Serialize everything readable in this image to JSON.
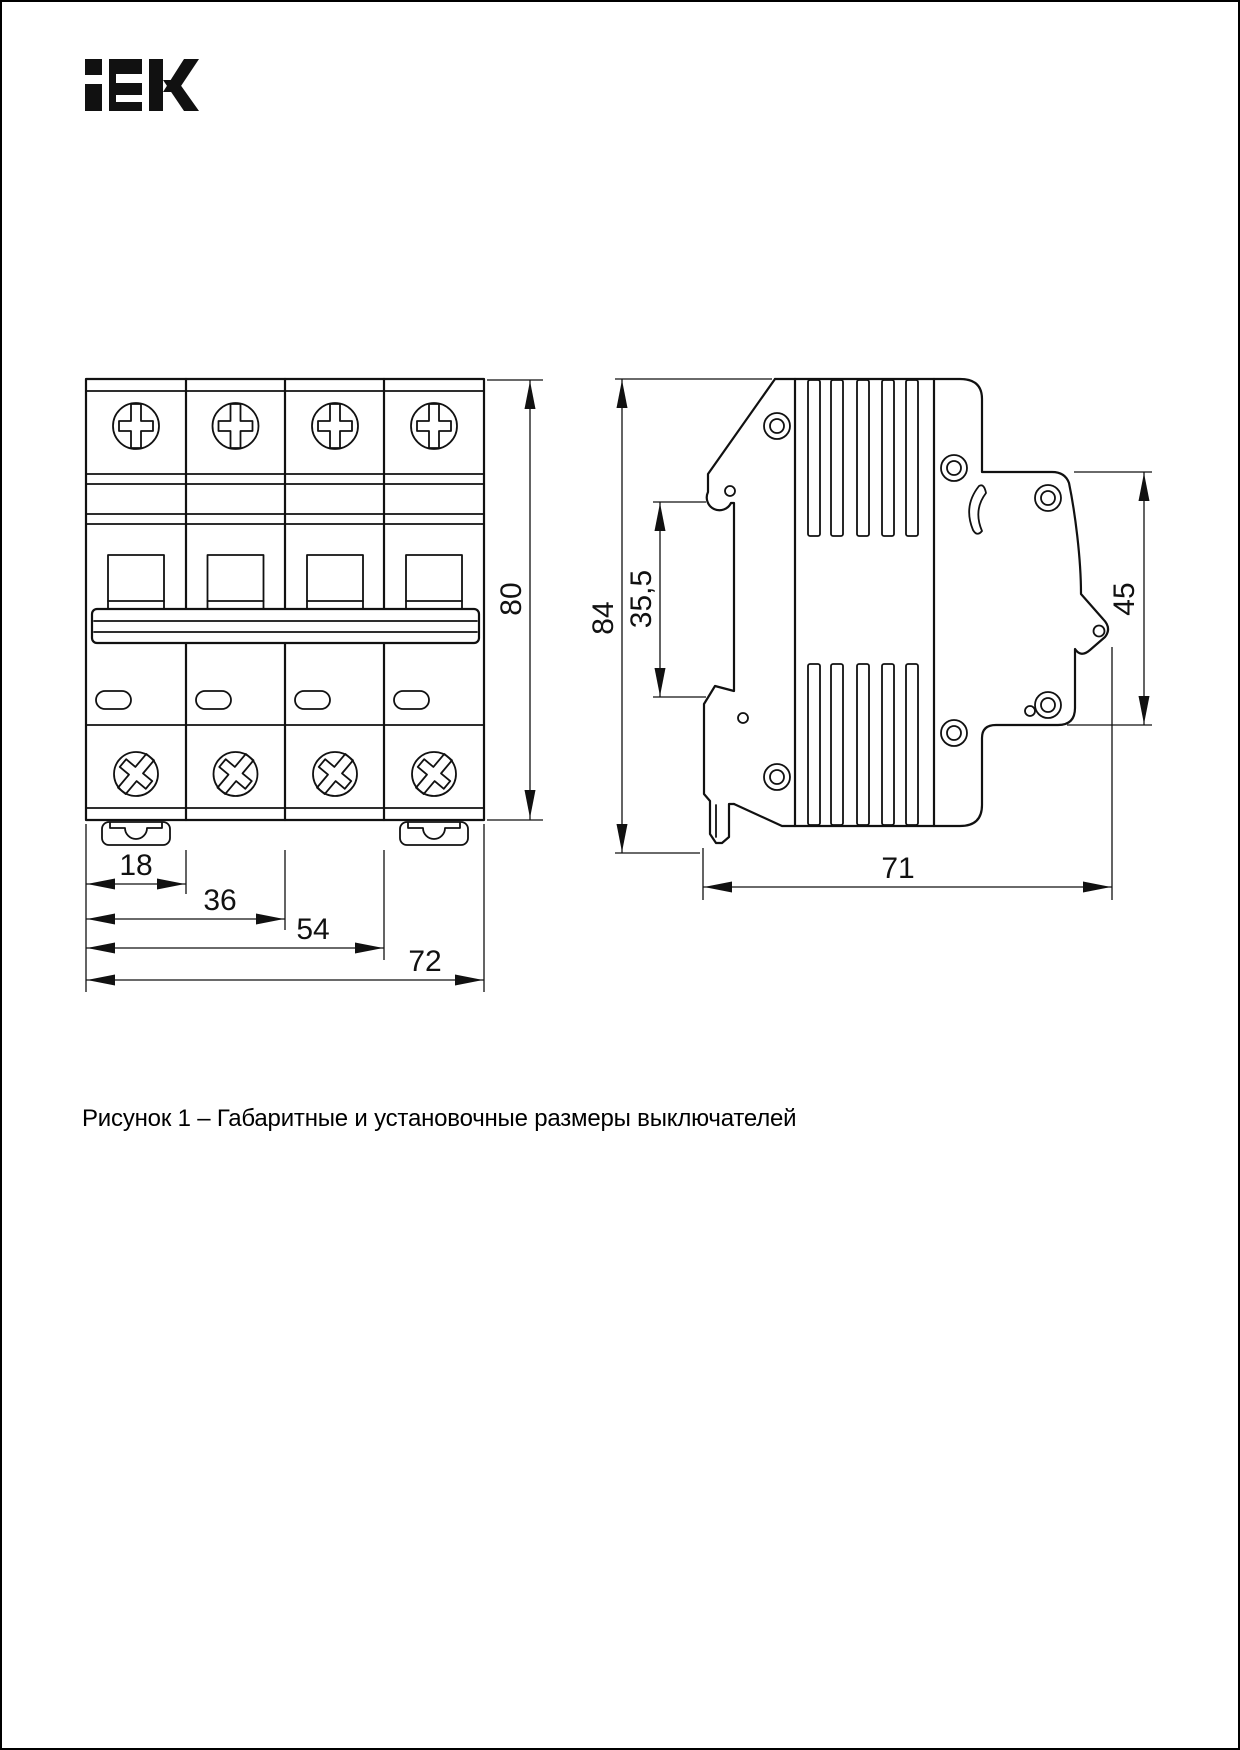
{
  "logo": {
    "text": "iEK"
  },
  "caption": {
    "text": "Рисунок 1 – Габаритные и установочные размеры выключателей"
  },
  "front_view": {
    "dims": {
      "d18": "18",
      "d36": "36",
      "d54": "54",
      "d72": "72",
      "d80": "80"
    }
  },
  "side_view": {
    "dims": {
      "d84": "84",
      "d35_5": "35,5",
      "d45": "45",
      "d71": "71"
    }
  },
  "colors": {
    "line": "#111111",
    "paper": "#ffffff"
  }
}
